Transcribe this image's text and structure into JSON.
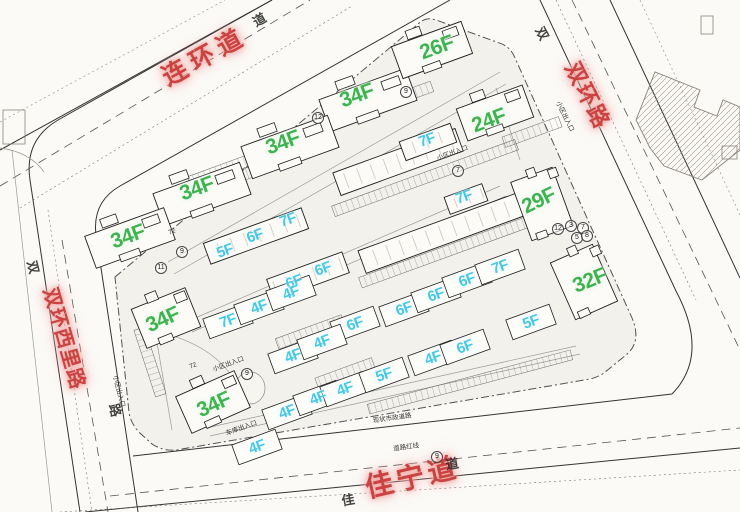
{
  "roads": {
    "top": {
      "label": "连环道"
    },
    "right": {
      "label": "双环路"
    },
    "left": {
      "label": "双环西里路"
    },
    "bottom": {
      "label": "佳宁道"
    }
  },
  "road_chars": [
    {
      "text": "道",
      "x": 259,
      "y": 19,
      "r": -30
    },
    {
      "text": "双",
      "x": 543,
      "y": 33,
      "r": 62
    },
    {
      "text": "双",
      "x": 34,
      "y": 267,
      "r": 76
    },
    {
      "text": "路",
      "x": 116,
      "y": 410,
      "r": 76
    },
    {
      "text": "佳",
      "x": 348,
      "y": 499,
      "r": -10
    },
    {
      "text": "道",
      "x": 452,
      "y": 463,
      "r": -10
    }
  ],
  "floor_labels": [
    {
      "t": "34F",
      "type": "g",
      "x": 357,
      "y": 96,
      "r": -20,
      "bld": false
    },
    {
      "t": "26F",
      "type": "g",
      "x": 437,
      "y": 48,
      "r": -20,
      "bld": false
    },
    {
      "t": "24F",
      "type": "g",
      "x": 489,
      "y": 121,
      "r": -20,
      "bld": false
    },
    {
      "t": "34F",
      "type": "g",
      "x": 283,
      "y": 143,
      "r": -20,
      "bld": false
    },
    {
      "t": "34F",
      "type": "g",
      "x": 197,
      "y": 189,
      "r": -20,
      "bld": false
    },
    {
      "t": "34F",
      "type": "g",
      "x": 128,
      "y": 237,
      "r": -20,
      "bld": false
    },
    {
      "t": "34F",
      "type": "g",
      "x": 163,
      "y": 320,
      "r": -24,
      "bld": false
    },
    {
      "t": "34F",
      "type": "g",
      "x": 214,
      "y": 405,
      "r": -24,
      "bld": false
    },
    {
      "t": "29F",
      "type": "g",
      "x": 539,
      "y": 201,
      "r": -26,
      "bld": false
    },
    {
      "t": "32F",
      "type": "g",
      "x": 590,
      "y": 281,
      "r": -22,
      "bld": false
    },
    {
      "t": "7F",
      "type": "c",
      "x": 427,
      "y": 140,
      "r": -20,
      "bld": false
    },
    {
      "t": "7F",
      "type": "c",
      "x": 464,
      "y": 197,
      "r": -20,
      "bld": false
    },
    {
      "t": "5F",
      "type": "c",
      "x": 225,
      "y": 251,
      "r": -20,
      "bld": false
    },
    {
      "t": "6F",
      "type": "c",
      "x": 255,
      "y": 236,
      "r": -20,
      "bld": false
    },
    {
      "t": "7F",
      "type": "c",
      "x": 288,
      "y": 220,
      "r": -20,
      "bld": false
    },
    {
      "t": "6F",
      "type": "c",
      "x": 294,
      "y": 282,
      "r": -20,
      "bld": false
    },
    {
      "t": "6F",
      "type": "c",
      "x": 323,
      "y": 269,
      "r": -20,
      "bld": false
    },
    {
      "t": "7F",
      "type": "c",
      "x": 228,
      "y": 321,
      "r": -20,
      "bld": true
    },
    {
      "t": "4F",
      "type": "c",
      "x": 259,
      "y": 307,
      "r": -20,
      "bld": true
    },
    {
      "t": "4F",
      "type": "c",
      "x": 291,
      "y": 293,
      "r": -20,
      "bld": true
    },
    {
      "t": "6F",
      "type": "c",
      "x": 355,
      "y": 324,
      "r": -20,
      "bld": true
    },
    {
      "t": "6F",
      "type": "c",
      "x": 404,
      "y": 309,
      "r": -20,
      "bld": true
    },
    {
      "t": "6F",
      "type": "c",
      "x": 436,
      "y": 295,
      "r": -20,
      "bld": true
    },
    {
      "t": "6F",
      "type": "c",
      "x": 467,
      "y": 280,
      "r": -20,
      "bld": true
    },
    {
      "t": "7F",
      "type": "c",
      "x": 500,
      "y": 267,
      "r": -20,
      "bld": true
    },
    {
      "t": "4F",
      "type": "c",
      "x": 293,
      "y": 356,
      "r": -20,
      "bld": true
    },
    {
      "t": "4F",
      "type": "c",
      "x": 322,
      "y": 342,
      "r": -20,
      "bld": true
    },
    {
      "t": "4F",
      "type": "c",
      "x": 433,
      "y": 358,
      "r": -20,
      "bld": true
    },
    {
      "t": "6F",
      "type": "c",
      "x": 465,
      "y": 347,
      "r": -20,
      "bld": true
    },
    {
      "t": "5F",
      "type": "c",
      "x": 531,
      "y": 322,
      "r": -20,
      "bld": true
    },
    {
      "t": "4F",
      "type": "c",
      "x": 287,
      "y": 412,
      "r": -20,
      "bld": true
    },
    {
      "t": "4F",
      "type": "c",
      "x": 318,
      "y": 398,
      "r": -20,
      "bld": true
    },
    {
      "t": "4F",
      "type": "c",
      "x": 345,
      "y": 389,
      "r": -20,
      "bld": true
    },
    {
      "t": "5F",
      "type": "c",
      "x": 384,
      "y": 375,
      "r": -20,
      "bld": true
    },
    {
      "t": "4F",
      "type": "c",
      "x": 257,
      "y": 447,
      "r": -20,
      "bld": true
    }
  ],
  "annotations": [
    {
      "text": "小区出入口",
      "x": 566,
      "y": 116,
      "r": 64
    },
    {
      "text": "小区出入口",
      "x": 120,
      "y": 391,
      "r": 76
    },
    {
      "text": "小区出入口",
      "x": 228,
      "y": 363,
      "r": -20
    },
    {
      "text": "车库出入口",
      "x": 241,
      "y": 427,
      "r": -20
    },
    {
      "text": "小区出入口",
      "x": 452,
      "y": 152,
      "r": -20
    },
    {
      "text": "道路红线",
      "x": 406,
      "y": 446,
      "r": -8
    },
    {
      "text": "现状市政道路",
      "x": 392,
      "y": 417,
      "r": -8
    },
    {
      "text": "72",
      "x": 172,
      "y": 232,
      "r": -20
    },
    {
      "text": "72",
      "x": 193,
      "y": 366,
      "r": -20
    }
  ],
  "building_numbers": [
    {
      "n": "12",
      "x": 318,
      "y": 118
    },
    {
      "n": "9",
      "x": 406,
      "y": 92
    },
    {
      "n": "9",
      "x": 182,
      "y": 252
    },
    {
      "n": "11",
      "x": 161,
      "y": 268
    },
    {
      "n": "7",
      "x": 458,
      "y": 171
    },
    {
      "n": "12",
      "x": 558,
      "y": 229
    },
    {
      "n": "3",
      "x": 571,
      "y": 226
    },
    {
      "n": "7",
      "x": 583,
      "y": 228
    },
    {
      "n": "5",
      "x": 577,
      "y": 238
    },
    {
      "n": "8",
      "x": 587,
      "y": 236
    },
    {
      "n": "9",
      "x": 247,
      "y": 374
    },
    {
      "n": "9",
      "x": 437,
      "y": 457
    }
  ],
  "buildings": {
    "towers": [
      {
        "x": 368,
        "y": 100,
        "w": 92,
        "h": 34,
        "r": -20
      },
      {
        "x": 432,
        "y": 50,
        "w": 74,
        "h": 34,
        "r": -20
      },
      {
        "x": 495,
        "y": 113,
        "w": 70,
        "h": 34,
        "r": -20
      },
      {
        "x": 290,
        "y": 147,
        "w": 92,
        "h": 34,
        "r": -20
      },
      {
        "x": 202,
        "y": 194,
        "w": 92,
        "h": 34,
        "r": -20
      },
      {
        "x": 130,
        "y": 238,
        "w": 84,
        "h": 34,
        "r": -20
      },
      {
        "x": 166,
        "y": 318,
        "w": 58,
        "h": 42,
        "r": -22
      },
      {
        "x": 213,
        "y": 402,
        "w": 64,
        "h": 40,
        "r": -24
      },
      {
        "x": 542,
        "y": 204,
        "w": 44,
        "h": 62,
        "r": -20
      },
      {
        "x": 584,
        "y": 282,
        "w": 46,
        "h": 62,
        "r": -24
      }
    ],
    "slabs": [
      {
        "x": 398,
        "y": 162,
        "w": 130,
        "h": 24,
        "r": -20
      },
      {
        "x": 442,
        "y": 233,
        "w": 170,
        "h": 24,
        "r": -20
      },
      {
        "x": 256,
        "y": 236,
        "w": 104,
        "h": 22,
        "r": -20
      },
      {
        "x": 308,
        "y": 276,
        "w": 80,
        "h": 22,
        "r": -20
      },
      {
        "x": 428,
        "y": 142,
        "w": 54,
        "h": 20,
        "r": -20
      },
      {
        "x": 466,
        "y": 199,
        "w": 40,
        "h": 18,
        "r": -20
      }
    ],
    "parking": [
      {
        "x": 345,
        "y": 118,
        "w": 185,
        "h": 11,
        "r": -20
      },
      {
        "x": 262,
        "y": 168,
        "w": 120,
        "h": 11,
        "r": -20
      },
      {
        "x": 425,
        "y": 178,
        "w": 195,
        "h": 11,
        "r": -20
      },
      {
        "x": 445,
        "y": 252,
        "w": 180,
        "h": 11,
        "r": -20
      },
      {
        "x": 497,
        "y": 214,
        "w": 60,
        "h": 11,
        "r": -20
      },
      {
        "x": 222,
        "y": 170,
        "w": 70,
        "h": 11,
        "r": -20
      },
      {
        "x": 532,
        "y": 132,
        "w": 60,
        "h": 11,
        "r": -20
      },
      {
        "x": 150,
        "y": 362,
        "w": 70,
        "h": 11,
        "r": 72
      },
      {
        "x": 310,
        "y": 332,
        "w": 70,
        "h": 11,
        "r": -20
      },
      {
        "x": 345,
        "y": 373,
        "w": 60,
        "h": 11,
        "r": -20
      },
      {
        "x": 470,
        "y": 382,
        "w": 210,
        "h": 10,
        "r": -15
      }
    ]
  },
  "colors": {
    "tower_label": "#3fb34f",
    "lowrise_label": "#46c8e8",
    "road_label": "#cb4341",
    "line": "#333333",
    "parcel_fill": "#f3f1eb"
  }
}
